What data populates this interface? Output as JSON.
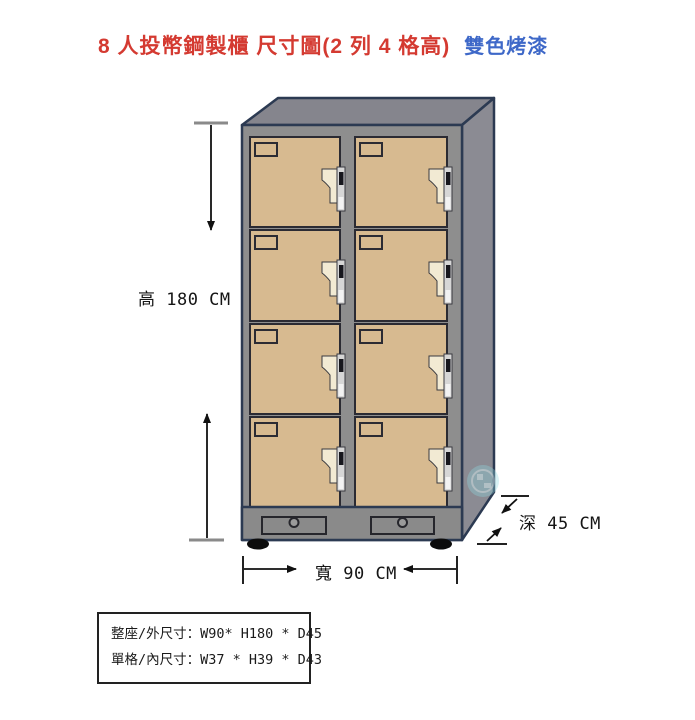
{
  "title": {
    "text": "8 人投幣鋼製櫃 尺寸圖(2 列 4 格高)",
    "finish_label": "雙色烤漆"
  },
  "dimension_labels": {
    "height": "高 180 CM",
    "width": "寬 90 CM",
    "depth": "深 45 CM"
  },
  "spec_box": {
    "overall": "整座/外尺寸：W90* H180 * D45",
    "cell": "單格/內尺寸：W37 * H39 * D43"
  },
  "locker": {
    "columns": 2,
    "rows": 4,
    "total_doors": 8,
    "coin_drawers": 2
  },
  "colors": {
    "title_red": "#d43a31",
    "title_blue": "#3e68c8",
    "door_tan": "#d7ba90",
    "frame_gray": "#8e8e8e",
    "base_gray": "#8a8a8a",
    "top_gray": "#85858d",
    "side_gray": "#8b8b93",
    "outline_navy": "#2c3a52",
    "lock_cream": "#f2ead3",
    "lock_bar_gray": "#d6d6d6",
    "watermark_cyan": "#8fd8df"
  }
}
